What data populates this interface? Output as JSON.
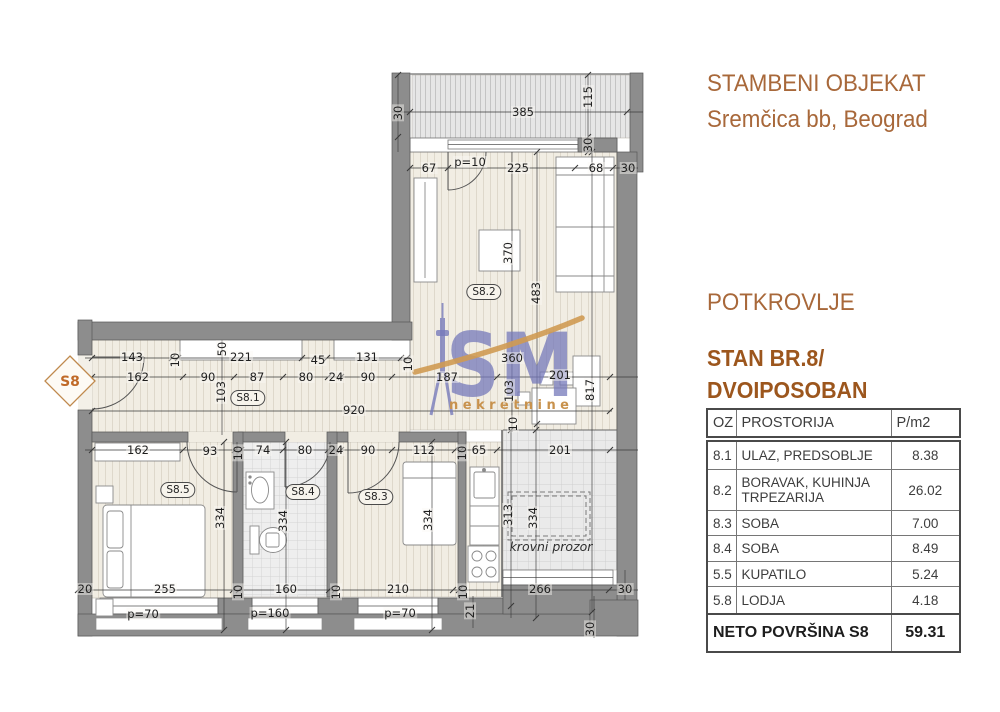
{
  "header": {
    "line1": "STAMBENI OBJEKAT",
    "line2": "Sremčica bb, Beograd"
  },
  "section": {
    "floor": "POTKROVLJE",
    "unit_line1": "STAN BR.8/",
    "unit_line2": "DVOIPOSOBAN"
  },
  "table": {
    "headers": {
      "oz": "OZ",
      "room": "PROSTORIJA",
      "area": "P/m2"
    },
    "rows": [
      {
        "oz": "8.1",
        "room": "ULAZ, PREDSOBLJE",
        "area": "8.38"
      },
      {
        "oz": "8.2",
        "room": "BORAVAK, KUHINJA TRPEZARIJA",
        "area": "26.02"
      },
      {
        "oz": "8.3",
        "room": "SOBA",
        "area": "7.00"
      },
      {
        "oz": "8.4",
        "room": "SOBA",
        "area": "8.49"
      },
      {
        "oz": "5.5",
        "room": "KUPATILO",
        "area": "5.24"
      },
      {
        "oz": "5.8",
        "room": "LODJA",
        "area": "4.18"
      }
    ],
    "footer": {
      "label": "NETO POVRŠINA S8",
      "value": "59.31"
    }
  },
  "plan": {
    "unit_tag": "S8",
    "watermark": {
      "text": "SM",
      "subtext": "nekretnine"
    },
    "room_labels": [
      {
        "t": "S8.1",
        "x": 248,
        "y": 398
      },
      {
        "t": "S8.2",
        "x": 484,
        "y": 292
      },
      {
        "t": "S8.3",
        "x": 376,
        "y": 497
      },
      {
        "t": "S8.4",
        "x": 303,
        "y": 492
      },
      {
        "t": "S8.5",
        "x": 178,
        "y": 490
      }
    ],
    "dim_labels": [
      {
        "t": "30",
        "x": 398,
        "y": 113,
        "r": 1
      },
      {
        "t": "385",
        "x": 523,
        "y": 112
      },
      {
        "t": "115",
        "x": 588,
        "y": 97,
        "r": 1
      },
      {
        "t": "30",
        "x": 588,
        "y": 145,
        "r": 1
      },
      {
        "t": "67",
        "x": 429,
        "y": 168
      },
      {
        "t": "p=10",
        "x": 470,
        "y": 162
      },
      {
        "t": "225",
        "x": 518,
        "y": 168
      },
      {
        "t": "68",
        "x": 596,
        "y": 168
      },
      {
        "t": "30",
        "x": 628,
        "y": 168
      },
      {
        "t": "370",
        "x": 508,
        "y": 253,
        "r": 1
      },
      {
        "t": "483",
        "x": 536,
        "y": 293,
        "r": 1
      },
      {
        "t": "143",
        "x": 132,
        "y": 357
      },
      {
        "t": "10",
        "x": 175,
        "y": 360,
        "r": 1
      },
      {
        "t": "50",
        "x": 222,
        "y": 349,
        "r": 1
      },
      {
        "t": "221",
        "x": 241,
        "y": 357
      },
      {
        "t": "45",
        "x": 318,
        "y": 360
      },
      {
        "t": "131",
        "x": 367,
        "y": 357
      },
      {
        "t": "10",
        "x": 408,
        "y": 364,
        "r": 1
      },
      {
        "t": "162",
        "x": 138,
        "y": 377
      },
      {
        "t": "90",
        "x": 208,
        "y": 377
      },
      {
        "t": "103",
        "x": 221,
        "y": 392,
        "r": 1
      },
      {
        "t": "87",
        "x": 257,
        "y": 377
      },
      {
        "t": "80",
        "x": 306,
        "y": 377
      },
      {
        "t": "24",
        "x": 336,
        "y": 377
      },
      {
        "t": "90",
        "x": 368,
        "y": 377
      },
      {
        "t": "187",
        "x": 447,
        "y": 377
      },
      {
        "t": "360",
        "x": 512,
        "y": 358
      },
      {
        "t": "201",
        "x": 560,
        "y": 375
      },
      {
        "t": "103",
        "x": 509,
        "y": 391,
        "r": 1
      },
      {
        "t": "817",
        "x": 590,
        "y": 390,
        "r": 1
      },
      {
        "t": "920",
        "x": 354,
        "y": 410
      },
      {
        "t": "10",
        "x": 513,
        "y": 424,
        "r": 1
      },
      {
        "t": "162",
        "x": 138,
        "y": 450
      },
      {
        "t": "93",
        "x": 210,
        "y": 451
      },
      {
        "t": "10",
        "x": 238,
        "y": 453,
        "r": 1
      },
      {
        "t": "74",
        "x": 263,
        "y": 450
      },
      {
        "t": "80",
        "x": 305,
        "y": 450
      },
      {
        "t": "24",
        "x": 336,
        "y": 450
      },
      {
        "t": "90",
        "x": 368,
        "y": 450
      },
      {
        "t": "112",
        "x": 424,
        "y": 450
      },
      {
        "t": "10",
        "x": 462,
        "y": 453,
        "r": 1
      },
      {
        "t": "65",
        "x": 479,
        "y": 450
      },
      {
        "t": "201",
        "x": 560,
        "y": 450
      },
      {
        "t": "334",
        "x": 220,
        "y": 518,
        "r": 1
      },
      {
        "t": "334",
        "x": 283,
        "y": 521,
        "r": 1
      },
      {
        "t": "334",
        "x": 428,
        "y": 520,
        "r": 1
      },
      {
        "t": "313",
        "x": 508,
        "y": 515,
        "r": 1
      },
      {
        "t": "334",
        "x": 533,
        "y": 518,
        "r": 1
      },
      {
        "t": "20",
        "x": 85,
        "y": 589
      },
      {
        "t": "255",
        "x": 165,
        "y": 589
      },
      {
        "t": "10",
        "x": 238,
        "y": 592,
        "r": 1
      },
      {
        "t": "160",
        "x": 286,
        "y": 589
      },
      {
        "t": "10",
        "x": 336,
        "y": 592,
        "r": 1
      },
      {
        "t": "210",
        "x": 398,
        "y": 589
      },
      {
        "t": "10",
        "x": 463,
        "y": 592,
        "r": 1
      },
      {
        "t": "266",
        "x": 540,
        "y": 589
      },
      {
        "t": "30",
        "x": 625,
        "y": 589
      },
      {
        "t": "p=70",
        "x": 143,
        "y": 614
      },
      {
        "t": "p=160",
        "x": 270,
        "y": 613
      },
      {
        "t": "p=70",
        "x": 400,
        "y": 613
      },
      {
        "t": "21",
        "x": 470,
        "y": 611,
        "r": 1
      },
      {
        "t": "30",
        "x": 590,
        "y": 629,
        "r": 1
      },
      {
        "t": "krovni prozor",
        "x": 551,
        "y": 547,
        "i": 1,
        "n": "roof-window-label"
      }
    ]
  },
  "colors": {
    "accent_brown": "#a8683a",
    "accent_dark_brown": "#9c561d",
    "wall_gray": "#8d8d8d",
    "watermark_blue": "#7478ba",
    "watermark_orange": "#cf9a52"
  }
}
